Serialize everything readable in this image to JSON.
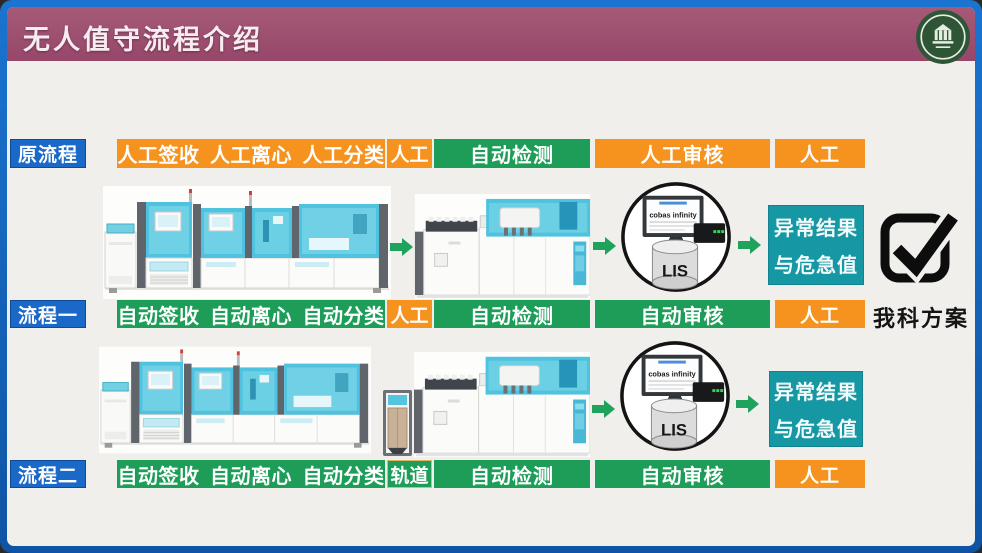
{
  "header": {
    "title": "无人值守流程介绍"
  },
  "rows": [
    {
      "id": "original",
      "label": "原流程",
      "steps": [
        {
          "text": "人工签收 人工离心 人工分类",
          "type": "manual"
        },
        {
          "text": "人工",
          "type": "manual"
        },
        {
          "text": "自动检测",
          "type": "auto"
        },
        {
          "text": "人工审核",
          "type": "manual"
        },
        {
          "text": "人工",
          "type": "manual"
        }
      ]
    },
    {
      "id": "flow1",
      "label": "流程一",
      "steps": [
        {
          "text": "自动签收 自动离心 自动分类",
          "type": "auto"
        },
        {
          "text": "人工",
          "type": "manual"
        },
        {
          "text": "自动检测",
          "type": "auto"
        },
        {
          "text": "自动审核",
          "type": "auto"
        },
        {
          "text": "人工",
          "type": "manual"
        }
      ]
    },
    {
      "id": "flow2",
      "label": "流程二",
      "steps": [
        {
          "text": "自动签收 自动离心 自动分类",
          "type": "auto"
        },
        {
          "text": "轨道",
          "type": "auto"
        },
        {
          "text": "自动检测",
          "type": "auto"
        },
        {
          "text": "自动审核",
          "type": "auto"
        },
        {
          "text": "人工",
          "type": "manual"
        }
      ]
    }
  ],
  "lis_node": {
    "screen_label": "cobas infinity",
    "database_label": "LIS"
  },
  "alert_box": {
    "line1": "异常结果",
    "line2": "与危急值"
  },
  "solution": {
    "label": "我科方案"
  },
  "colors": {
    "manual": "#F6921E",
    "auto": "#1D9D58",
    "alert": "#1598A3",
    "row_label": "#1A69C8",
    "header": "#9C4B6B",
    "frame": "#1565C2"
  }
}
